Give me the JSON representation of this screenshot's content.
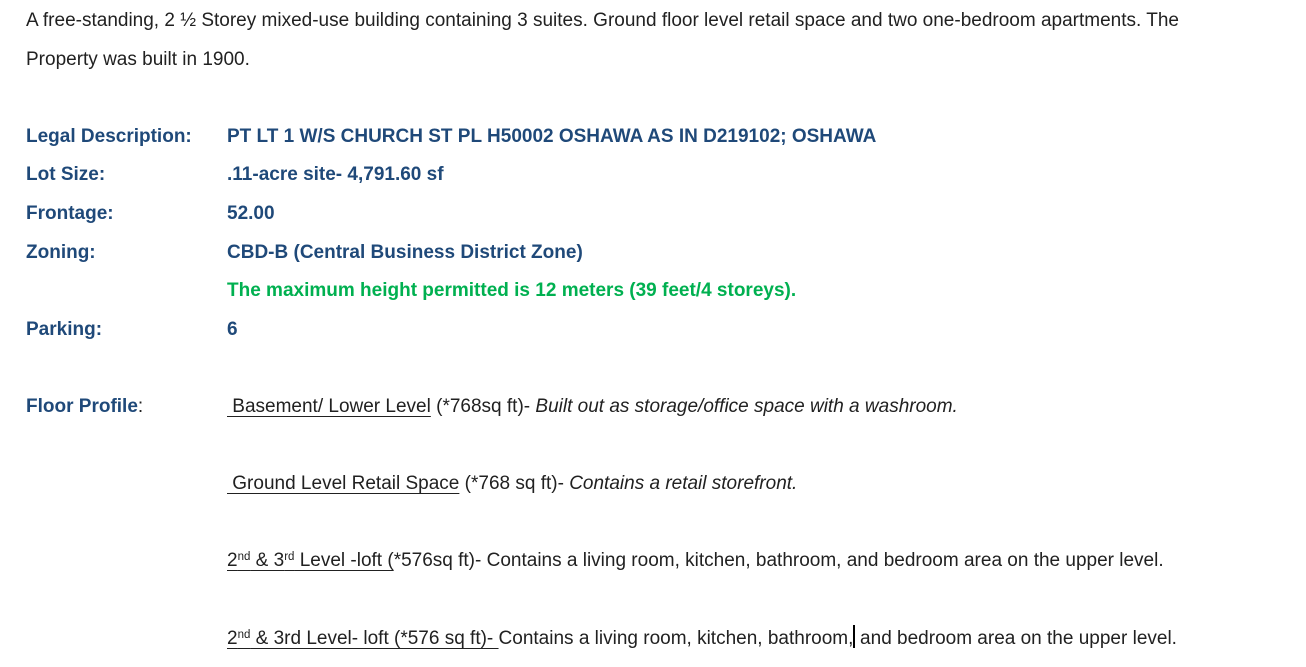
{
  "colors": {
    "accent_blue": "#1F4979",
    "note_green": "#00B050",
    "text_color": "#212121"
  },
  "intro": {
    "lines": [
      "A free-standing, 2 ½ Storey mixed-use building containing 3 suites. Ground floor level retail space and two one-bedroom apartments. The",
      "Property was built in 1900."
    ]
  },
  "fields": [
    {
      "label": "Legal Description:",
      "value": "PT LT 1 W/S CHURCH ST PL H50002 OSHAWA AS IN D219102; OSHAWA"
    },
    {
      "label": "Lot Size:",
      "value": ".11-acre site- 4,791.60 sf"
    },
    {
      "label": "Frontage:",
      "value": "52.00"
    },
    {
      "label": "Zoning:",
      "value": "CBD-B (Central Business District Zone)"
    },
    {
      "label": "",
      "value": "The maximum height permitted is 12 meters (39 feet/4 storeys)."
    },
    {
      "label": "Parking:",
      "value": "6"
    }
  ],
  "floor_profile": {
    "label": "Floor Profile",
    "colon": ":",
    "entries": {
      "basement": {
        "underlined": " Basement/ Lower Level",
        "mid": " (*768sq ft)- ",
        "italic": "Built out as storage/office space with a washroom."
      },
      "ground": {
        "underlined": " Ground Level Retail Space",
        "mid": " (*768 sq ft)- ",
        "italic": "Contains a retail storefront."
      },
      "upper_a": {
        "u1": "2",
        "sup1": "nd",
        "u2": " & 3",
        "sup2": "rd",
        "u3": " Level -loft (",
        "rest": "*576sq ft)- Contains a living room, kitchen, bathroom, and bedroom area on the upper level."
      },
      "upper_b": {
        "u1": "2",
        "sup1": "nd",
        "u2": " & 3rd Level- loft (*576 sq ft)- ",
        "rest_before_cursor": "Contains a living room, kitchen, bathroom,",
        "rest_after_cursor": " and bedroom area on the upper level."
      }
    }
  }
}
